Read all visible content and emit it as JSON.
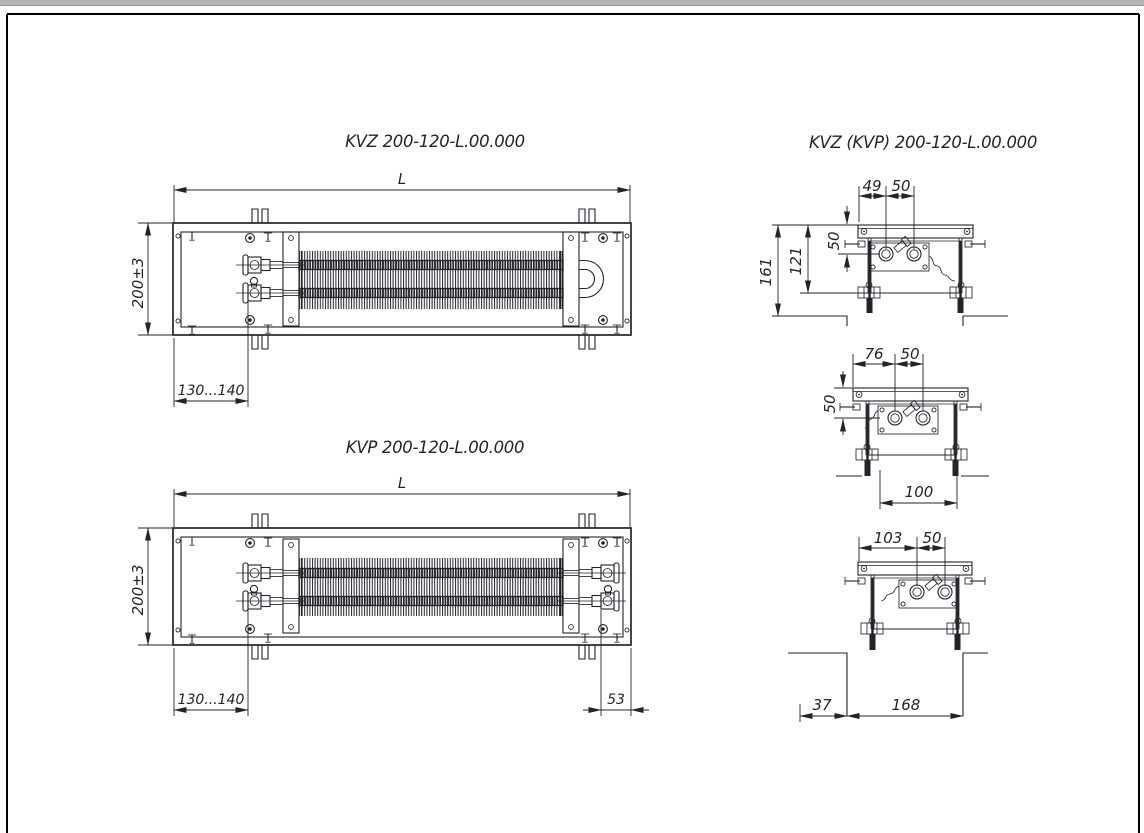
{
  "sheet": {
    "background": "#ffffff",
    "top_strip_color": "#b5b5b5",
    "frame_color": "#000000",
    "ink_color": "#23242b"
  },
  "kvz_plan": {
    "title": "KVZ 200-120-L.00.000",
    "dim_length": "L",
    "dim_width": "200±3",
    "dim_connection_offset": "130...140"
  },
  "kvp_plan": {
    "title": "KVP 200-120-L.00.000",
    "dim_length": "L",
    "dim_width": "200±3",
    "dim_connection_offset": "130...140",
    "dim_end_offset": "53"
  },
  "sections": {
    "title": "KVZ (KVP) 200-120-L.00.000",
    "top": {
      "dim_edge_to_pipe": "49",
      "dim_pipe_spacing": "50",
      "dim_total_depth": "161",
      "dim_body_depth": "121",
      "dim_pipe_depth": "50"
    },
    "middle": {
      "dim_edge_to_pipe": "76",
      "dim_pipe_spacing": "50",
      "dim_pipe_depth": "50",
      "dim_anchor_span": "100"
    },
    "bottom": {
      "dim_edge_to_pipe": "103",
      "dim_pipe_spacing": "50",
      "dim_floor_offset": "37",
      "dim_recess_width": "168"
    }
  }
}
